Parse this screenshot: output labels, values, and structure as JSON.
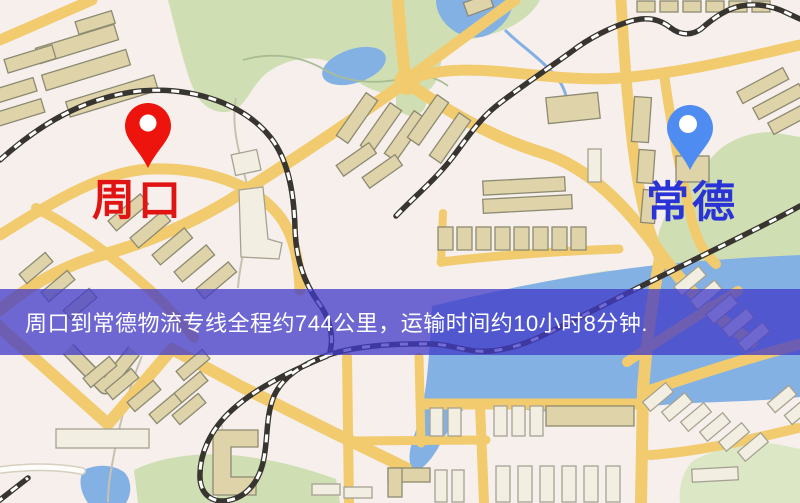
{
  "map": {
    "origin": {
      "label": "周口",
      "pin": "red-map-pin"
    },
    "destination": {
      "label": "常德",
      "pin": "blue-map-pin"
    }
  },
  "banner": {
    "text": "周口到常德物流专线全程约744公里，运输时间约10小时8分钟."
  },
  "colors": {
    "origin_label": "#e11414",
    "destination_label": "#2a33d6",
    "pin_red": "#ec140c",
    "pin_blue": "#4f8cf2",
    "banner_bg": "rgba(64,58,200,0.75)",
    "banner_text": "#ffffff",
    "road_yellow": "#f1cb6e",
    "park_green": "#cfdfb3",
    "water_blue": "#84b1e4",
    "map_background": "#f6efec"
  }
}
